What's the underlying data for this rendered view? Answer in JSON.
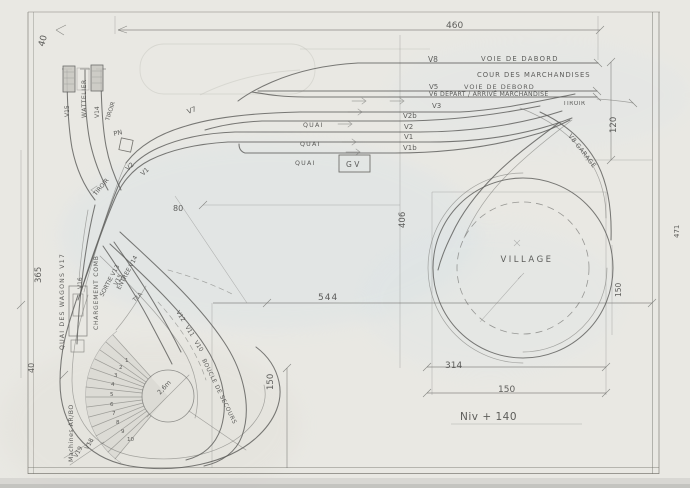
{
  "labels": {
    "dims": {
      "top_width": "460",
      "top_left_margin": "40",
      "right_upper": "120",
      "right_margin": "471",
      "center_height": "406",
      "center_width": "544",
      "lower_left_height": "150",
      "village_width": "314",
      "village_inner_width": "150",
      "village_right_height": "150",
      "level_note": "Niv + 140",
      "left_height": "365",
      "left_lower_margin": "40",
      "station_offset": "80",
      "turntable_diameter": "2,6m"
    },
    "station": {
      "v8": "V8",
      "voie_de_dabord": "VOIE DE DABORD",
      "cour_des_marchandises": "COUR DES MARCHANDISES",
      "v5": "V5",
      "voie_de_debord": "VOIE DE DEBORD",
      "v6_depart": "V6 DEPART / ARRIVÉ MARCHANDISE",
      "tiroir": "TIROIR",
      "v3": "V3",
      "v2b": "V2b",
      "v2": "V2",
      "v1": "V1",
      "v1b": "V1b",
      "quai": "QUAI",
      "gv": "G V",
      "v7": "V7"
    },
    "west": {
      "v15": "V15",
      "wattelier": "WATTELIER",
      "v14": "V14",
      "tiroir_v14": "TIROIR",
      "pn": "PN",
      "tiroir_main": "TIROIR",
      "v2": "V2",
      "v1": "V1",
      "quai_wagons": "QUAI DES WAGONS V17",
      "v16": "V16",
      "v15_small": "V15",
      "chargement": "CHARGEMENT COMB",
      "sortie_v13": "SORTIE V13",
      "entree_v14": "ENTREE V14",
      "t1a": "T1A"
    },
    "depot": {
      "machines": "Machines AR/BO",
      "v19": "V19",
      "v18": "V18",
      "turntable_numbers": [
        "1",
        "2",
        "3",
        "4",
        "5",
        "6",
        "7",
        "8",
        "9",
        "10"
      ],
      "v12": "V12",
      "v11": "V11",
      "v10": "V10",
      "boucle_secours": "BOUCLE DE SECOURS"
    },
    "east": {
      "v8_garage": "V8 GARAGE",
      "village": "VILLAGE"
    }
  }
}
